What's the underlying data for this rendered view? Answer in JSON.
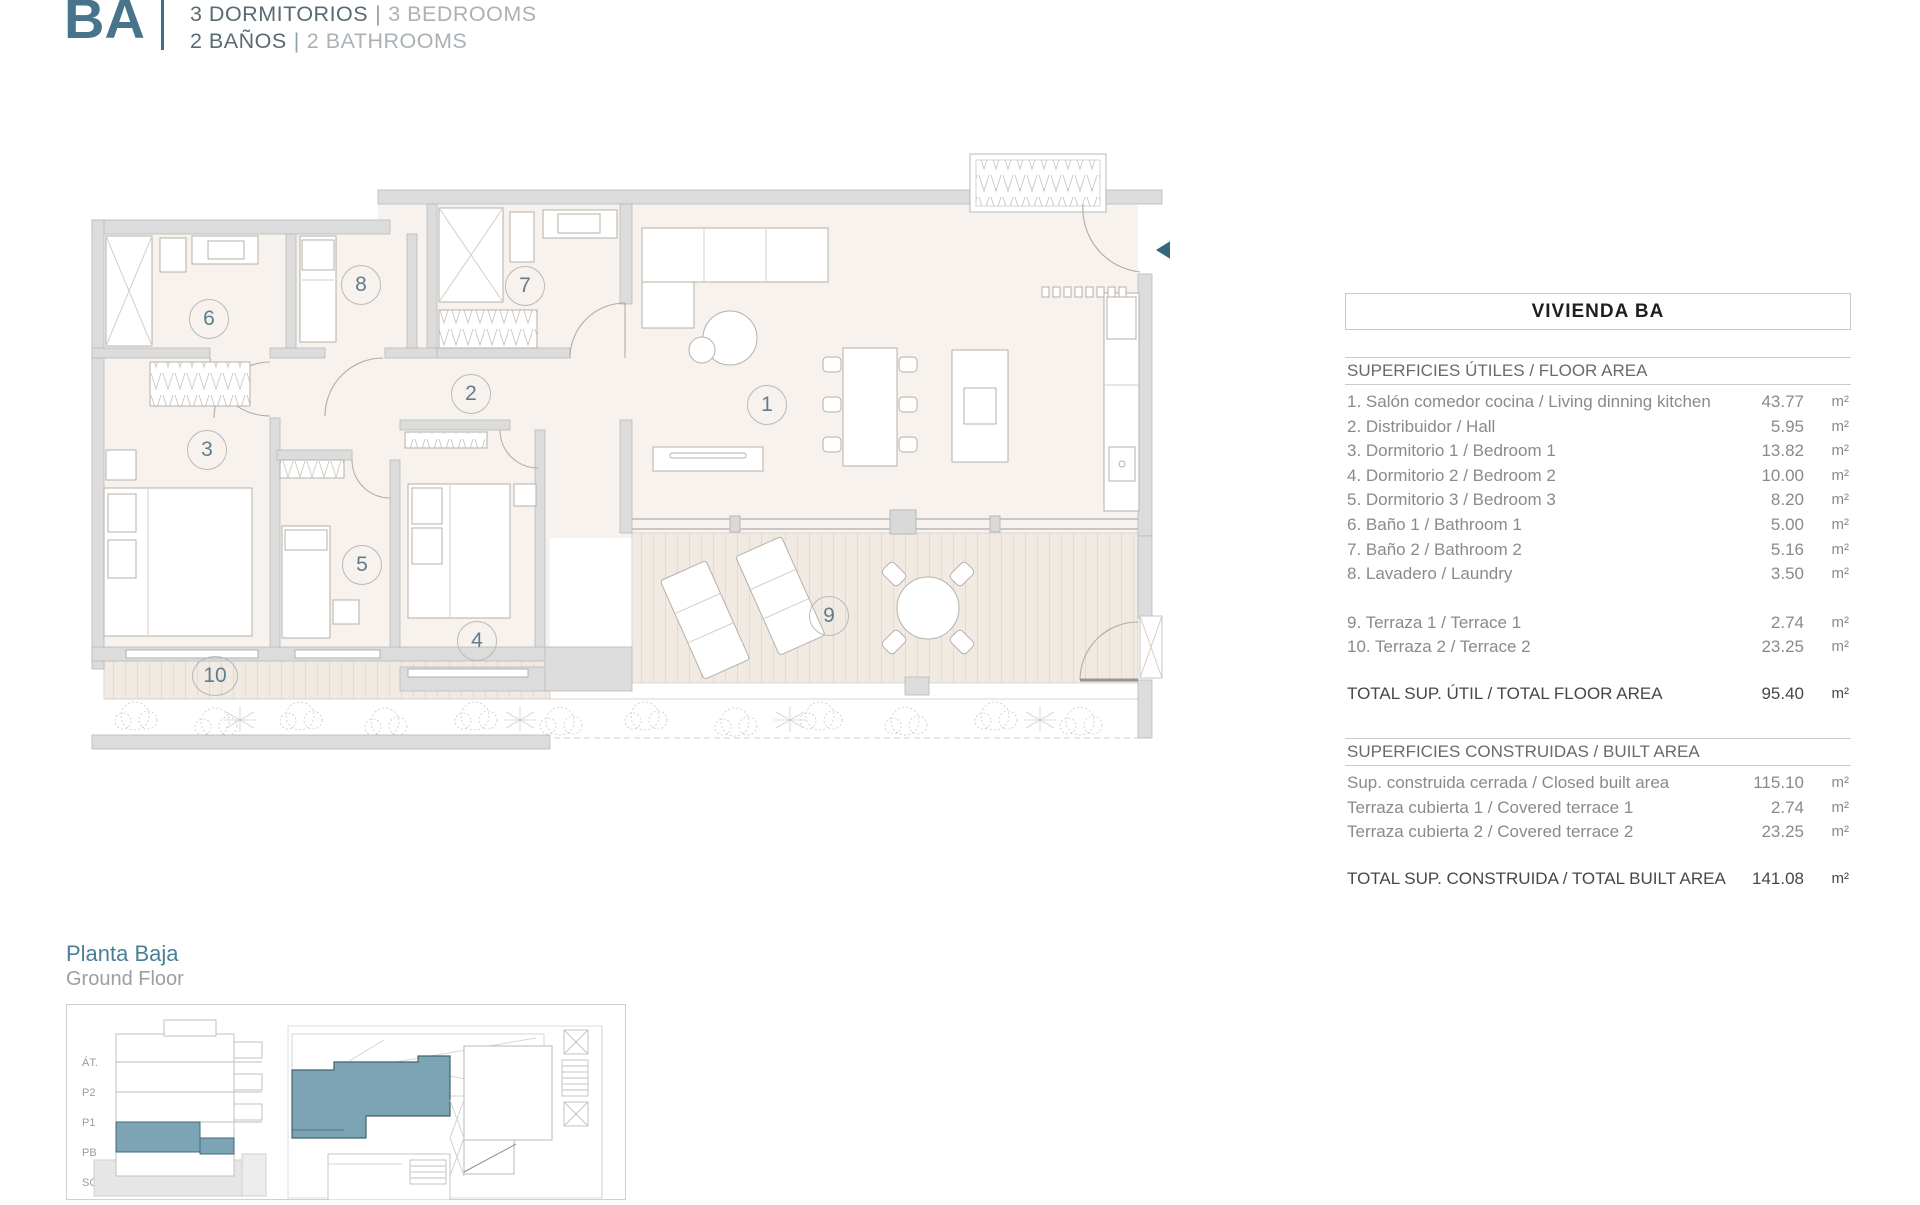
{
  "header": {
    "unit_code": "BA",
    "specs": [
      {
        "es": "3 DORMITORIOS",
        "sep": "|",
        "en": "3 BEDROOMS"
      },
      {
        "es": "2 BAÑOS",
        "sep": "|",
        "en": "2 BATHROOMS"
      }
    ]
  },
  "plan": {
    "rooms": [
      "1",
      "2",
      "3",
      "4",
      "5",
      "6",
      "7",
      "8",
      "9",
      "10"
    ]
  },
  "table": {
    "title": "VIVIENDA BA",
    "floor_section": {
      "header": "SUPERFICIES ÚTILES / FLOOR AREA",
      "rows": [
        {
          "label": "1. Salón comedor cocina / Living dinning kitchen",
          "value": "43.77",
          "unit": "m²"
        },
        {
          "label": "2. Distribuidor / Hall",
          "value": "5.95",
          "unit": "m²"
        },
        {
          "label": "3. Dormitorio 1 / Bedroom 1",
          "value": "13.82",
          "unit": "m²"
        },
        {
          "label": "4. Dormitorio 2 / Bedroom 2",
          "value": "10.00",
          "unit": "m²"
        },
        {
          "label": "5. Dormitorio 3 / Bedroom 3",
          "value": "8.20",
          "unit": "m²"
        },
        {
          "label": "6. Baño 1 / Bathroom 1",
          "value": "5.00",
          "unit": "m²"
        },
        {
          "label": "7. Baño 2 / Bathroom 2",
          "value": "5.16",
          "unit": "m²"
        },
        {
          "label": "8. Lavadero / Laundry",
          "value": "3.50",
          "unit": "m²"
        }
      ],
      "terrace_rows": [
        {
          "label": "9. Terraza 1 / Terrace 1",
          "value": "2.74",
          "unit": "m²"
        },
        {
          "label": "10. Terraza 2 / Terrace 2",
          "value": "23.25",
          "unit": "m²"
        }
      ],
      "total": {
        "label": "TOTAL SUP. ÚTIL / TOTAL FLOOR AREA",
        "value": "95.40",
        "unit": "m²"
      }
    },
    "built_section": {
      "header": "SUPERFICIES CONSTRUIDAS / BUILT AREA",
      "rows": [
        {
          "label": "Sup. construida cerrada / Closed built area",
          "value": "115.10",
          "unit": "m²"
        },
        {
          "label": "Terraza cubierta 1 / Covered terrace 1",
          "value": "2.74",
          "unit": "m²"
        },
        {
          "label": "Terraza cubierta 2 / Covered terrace 2",
          "value": "23.25",
          "unit": "m²"
        }
      ],
      "total": {
        "label": "TOTAL SUP. CONSTRUIDA /  TOTAL BUILT AREA",
        "value": "141.08",
        "unit": "m²"
      }
    }
  },
  "footer": {
    "floor_es": "Planta Baja",
    "floor_en": "Ground Floor",
    "section_levels": [
      "ÁT.",
      "P2",
      "P1",
      "PB",
      "SÓT."
    ]
  },
  "colors": {
    "accent_teal": "#47748b",
    "divider_teal": "#3f7089",
    "highlight_teal": "#7ca4b4",
    "arrow_teal": "#35687f",
    "wall_gray": "#dcdcdc",
    "floor_cream": "#f7f2ed"
  }
}
